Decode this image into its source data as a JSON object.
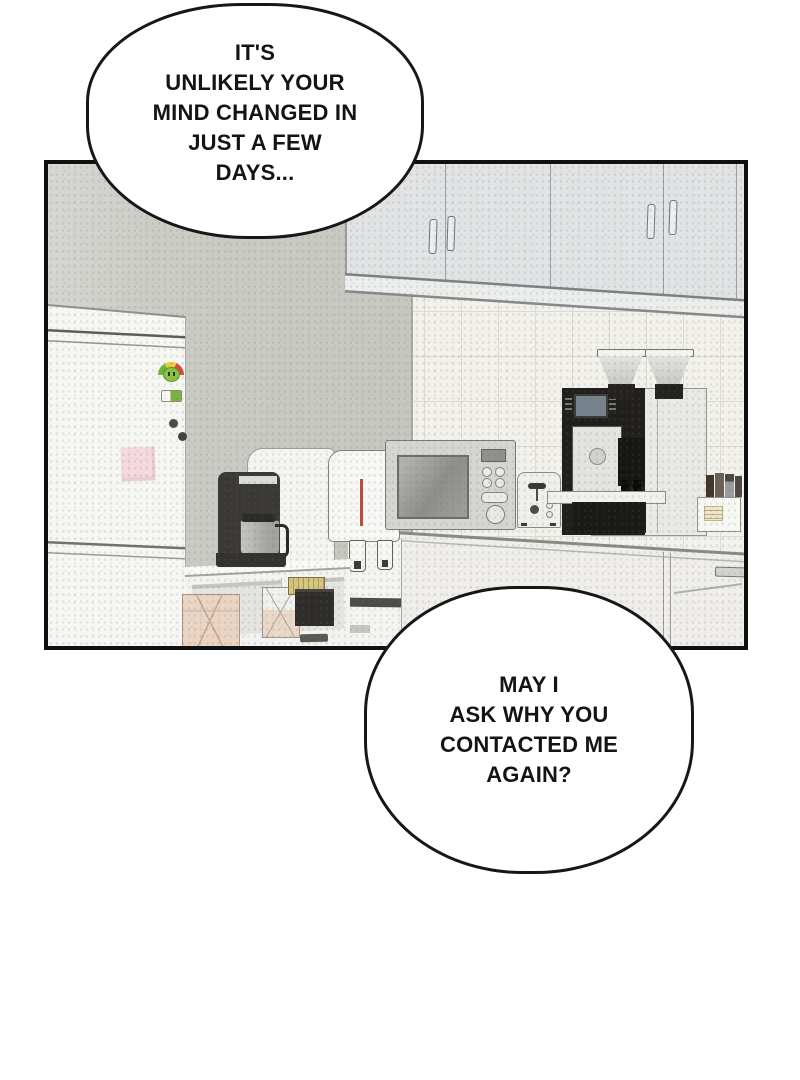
{
  "bubbles": [
    {
      "name": "speech-bubble-top",
      "lines": [
        "IT'S",
        "UNLIKELY YOUR",
        "MIND CHANGED IN",
        "JUST A FEW",
        "DAYS..."
      ]
    },
    {
      "name": "speech-bubble-bottom",
      "lines": [
        "MAY I",
        "ASK WHY YOU",
        "CONTACTED ME",
        "AGAIN?"
      ]
    }
  ],
  "panel": {
    "scene": "office kitchen interior",
    "objects": [
      "refrigerator",
      "fridge-magnets",
      "sticky-note",
      "upper-cabinets",
      "tile-backsplash",
      "sideboard",
      "storage-boxes",
      "coffee-maker",
      "water-purifier",
      "microwave",
      "toaster",
      "espresso-machine",
      "bean-hoppers",
      "stick-caddy",
      "counter-cabinets"
    ]
  },
  "colors": {
    "page_background": "#ffffff",
    "panel_border": "#101010",
    "bubble_fill": "#ffffff",
    "bubble_stroke": "#171717",
    "wall": "#c9cac4",
    "tile": "#f2f1ec",
    "cabinet": "#e1e3e5",
    "fridge": "#f6f6f3",
    "counter": "#efeeeb",
    "appliance_dark": "#2e2d2a",
    "hot_water_stripe": "#bf4a3e",
    "cold_water_stripe": "#41639f",
    "sticky_note": "#f4d9de",
    "box_tan": "#ead4c4",
    "energy_green": "#6fb43e",
    "energy_yellow": "#f1c93e",
    "energy_red": "#d8473c"
  }
}
